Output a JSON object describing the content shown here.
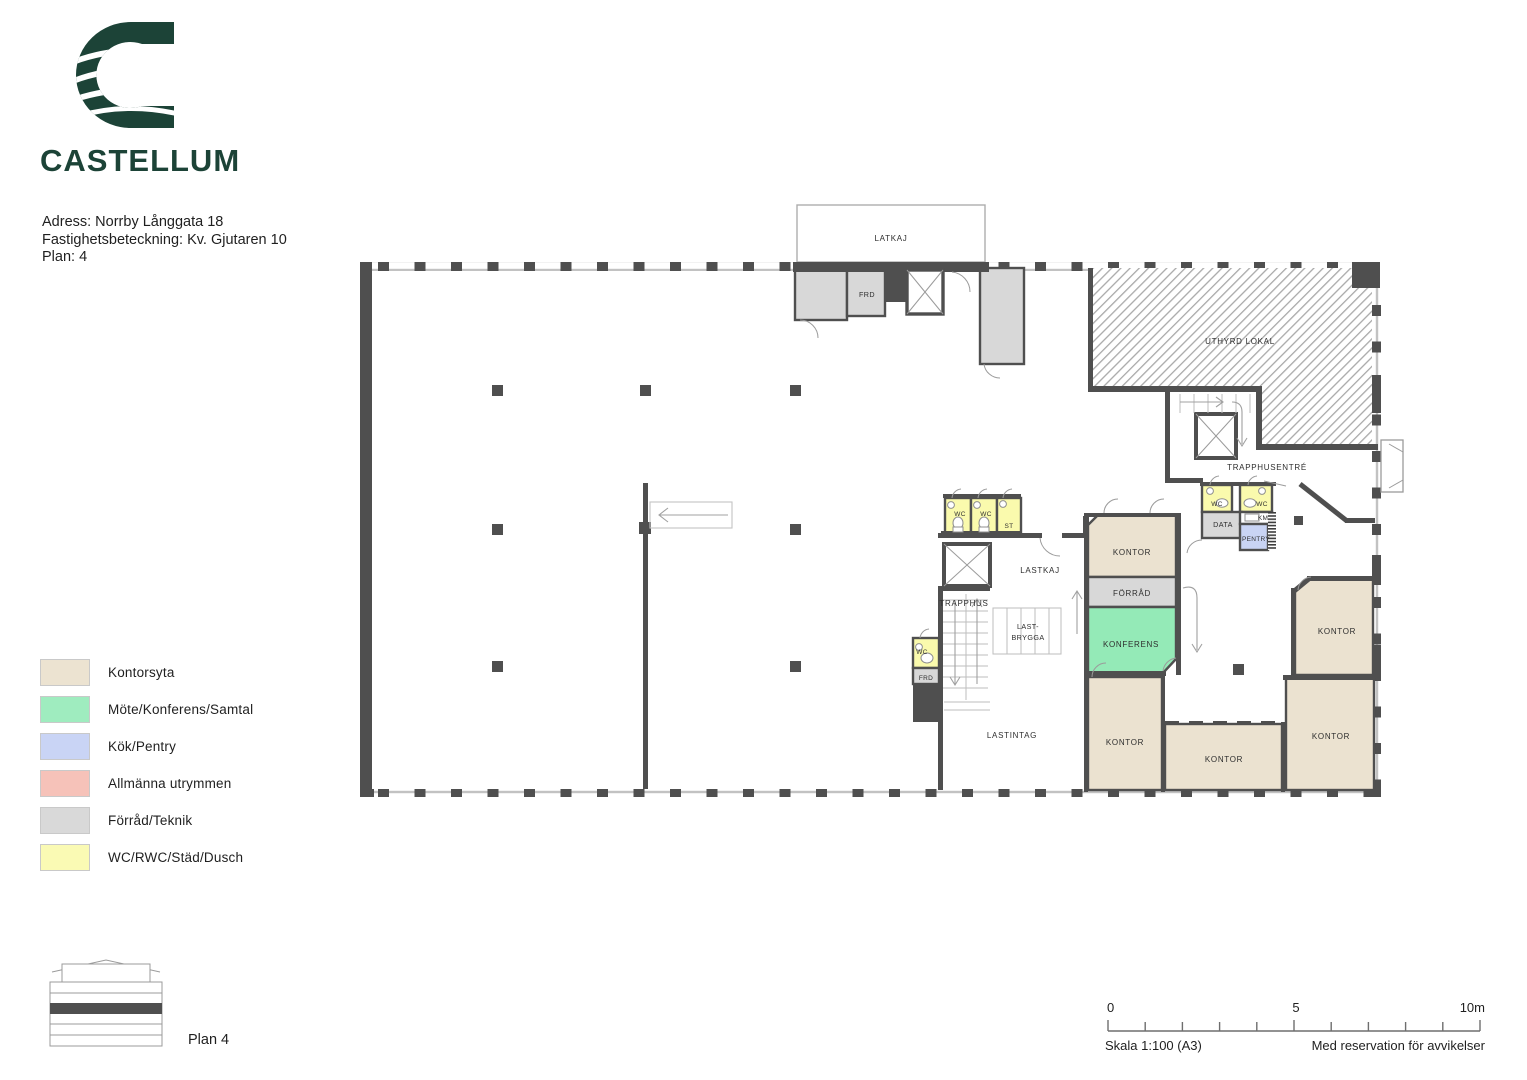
{
  "brand": {
    "wordmark": "CASTELLUM",
    "logo_color": "#1c4337"
  },
  "header": {
    "address": "Adress: Norrby Långgata 18",
    "property": "Fastighetsbeteckning: Kv. Gjutaren 10",
    "plan": "Plan: 4"
  },
  "legend": {
    "items": [
      {
        "label": "Kontorsyta",
        "color": "#ece3d1"
      },
      {
        "label": "Möte/Konferens/Samtal",
        "color": "#9fecbf"
      },
      {
        "label": "Kök/Pentry",
        "color": "#c9d4f5"
      },
      {
        "label": "Allmänna utrymmen",
        "color": "#f6c2b9"
      },
      {
        "label": "Förråd/Teknik",
        "color": "#d9d9d9"
      },
      {
        "label": "WC/RWC/Städ/Dusch",
        "color": "#fafab4"
      }
    ]
  },
  "floor_indicator": {
    "label": "Plan 4"
  },
  "scale_bar": {
    "start": "0",
    "middle": "5",
    "end": "10m",
    "scale": "Skala 1:100  (A3)",
    "disclaimer": "Med reservation för avvikelser"
  },
  "plan": {
    "labels": {
      "latkaj": "LATKAJ",
      "frd": "FRD",
      "uthyrd_lokal": "UTHYRD LOKAL",
      "trapphusentre": "TRAPPHUSENTRÉ",
      "wc": "WC",
      "st": "ST",
      "data": "DATA",
      "km": "KM",
      "pentry": "PENTRY",
      "lastkaj": "LASTKAJ",
      "trapphus": "TRAPPHUS",
      "lastbrygga_line1": "LAST-",
      "lastbrygga_line2": "BRYGGA",
      "lastintag": "LASTINTAG",
      "kontor": "KONTOR",
      "forrad": "FÖRRÅD",
      "konferens": "KONFERENS"
    }
  }
}
